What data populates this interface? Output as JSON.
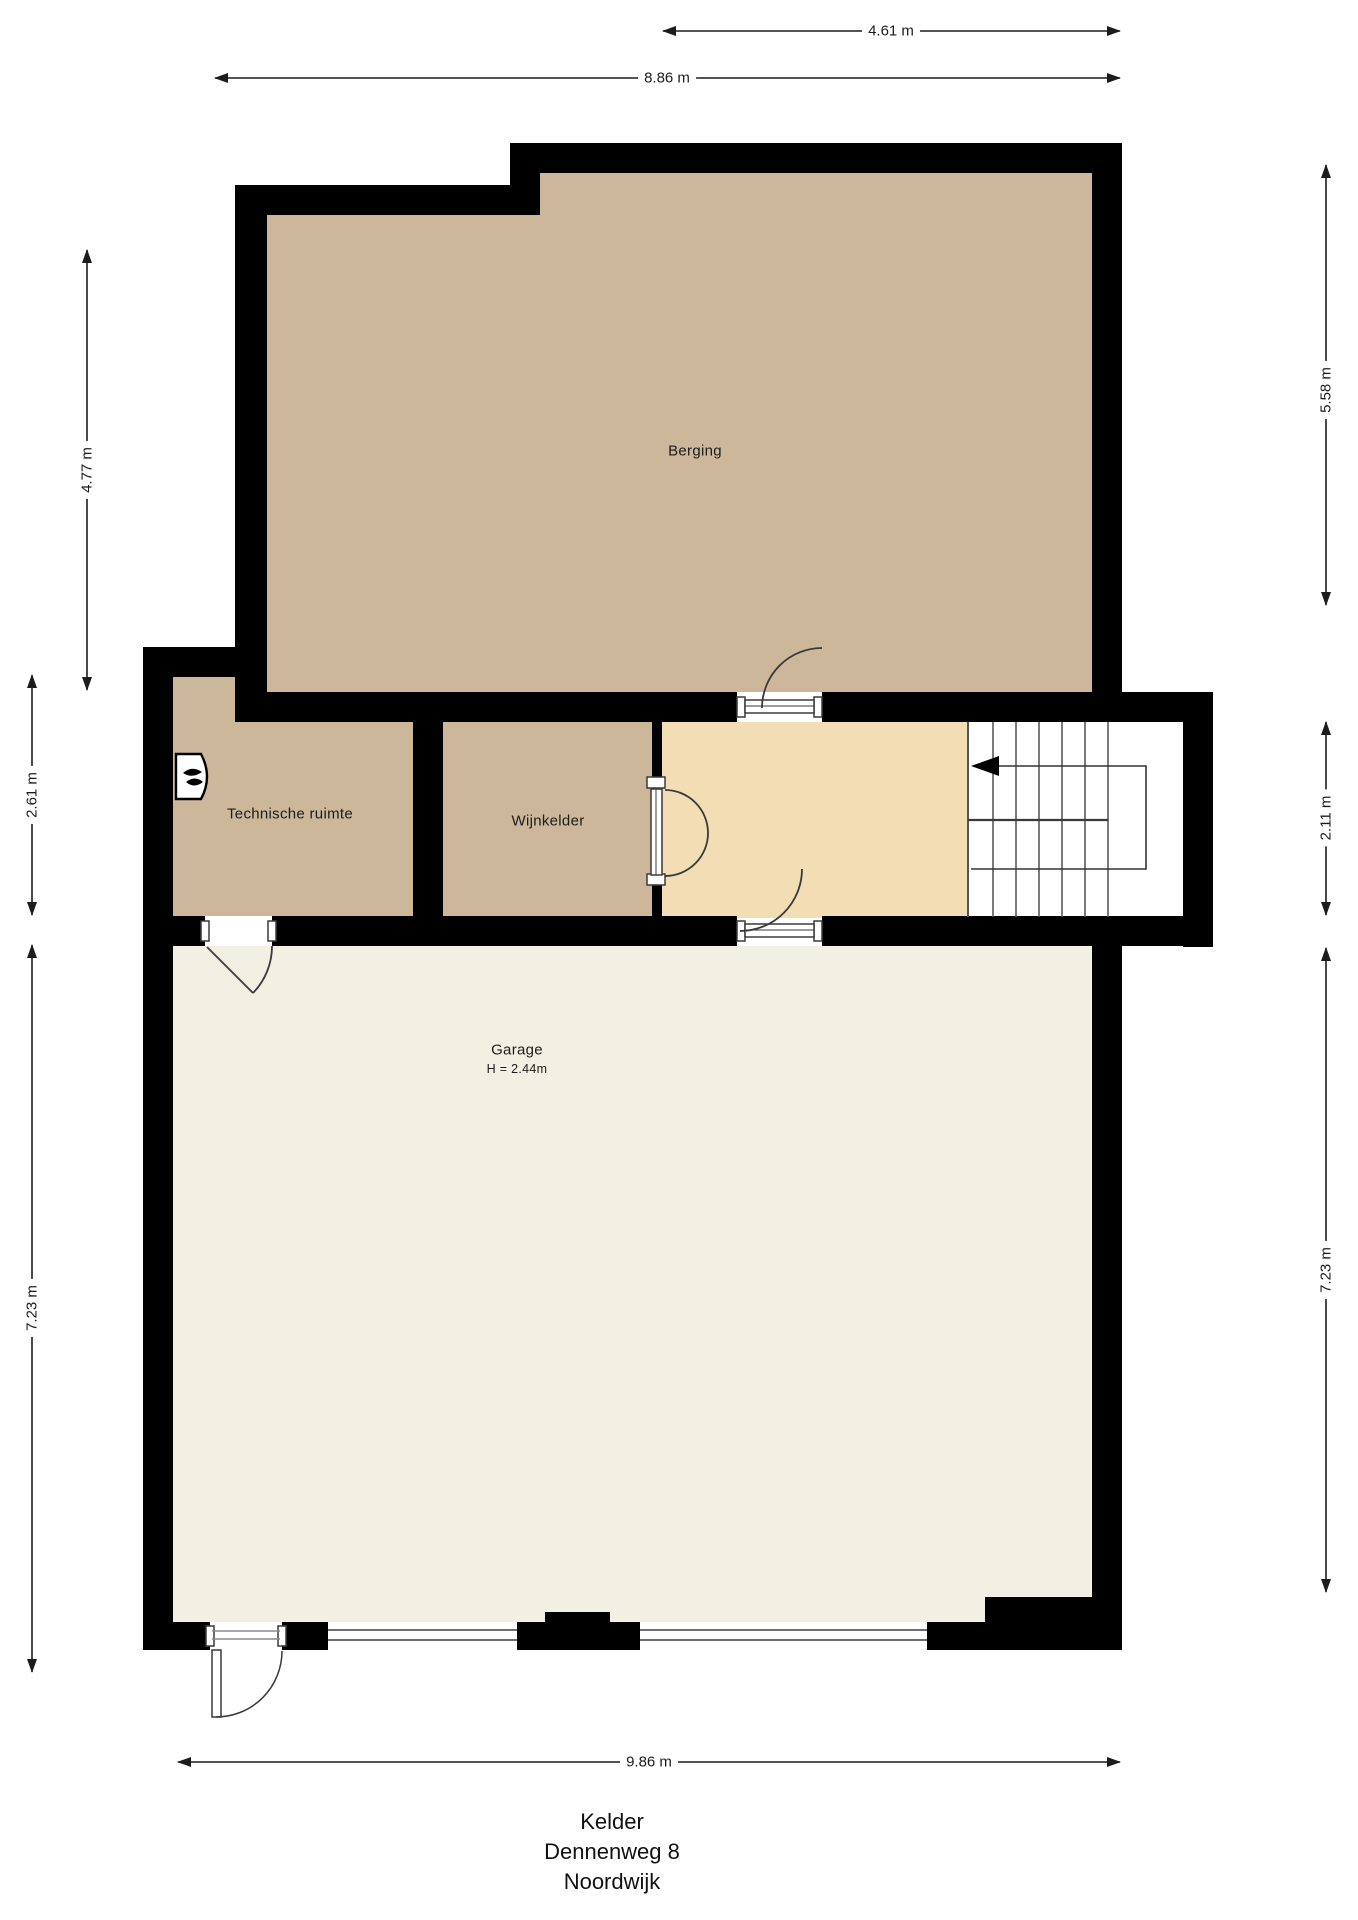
{
  "title": {
    "floor": "Kelder",
    "street": "Dennenweg 8",
    "city": "Noordwijk"
  },
  "rooms": {
    "berging": {
      "label": "Berging"
    },
    "technische_ruimte": {
      "label": "Technische ruimte"
    },
    "wijnkelder": {
      "label": "Wijnkelder"
    },
    "garage": {
      "label": "Garage",
      "height": "H = 2.44m"
    },
    "stairwell": {
      "label": ""
    }
  },
  "dimensions": {
    "top_partial": "4.61 m",
    "top_full": "8.86 m",
    "left_upper": "4.77 m",
    "left_middle": "2.61 m",
    "left_lower": "7.23 m",
    "right_upper": "5.58 m",
    "right_middle": "2.11 m",
    "right_lower": "7.23 m",
    "bottom": "9.86 m"
  },
  "colors": {
    "wall": "#000000",
    "room_tan": "#cdb79a",
    "hall_cream": "#f2ddb4",
    "garage_floor": "#f2f0e3",
    "stair_floor": "#ffffff",
    "dim_line": "#1c1c1c",
    "stair_line": "#5a5a5a",
    "door_line": "#3a3a3a"
  }
}
